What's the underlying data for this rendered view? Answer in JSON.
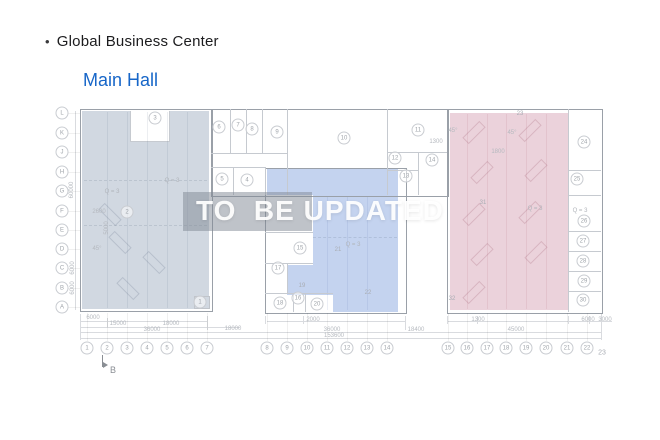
{
  "header": {
    "bullet": "•",
    "title": "Global Business Center",
    "subtitle": "Main Hall"
  },
  "watermark": {
    "text": "TO  BE UPDATED"
  },
  "colors": {
    "left_region": "#cdd5de",
    "middle_region": "#bfcfee",
    "right_region": "#e9ced8",
    "subtitle_blue": "#1766c8"
  },
  "plan": {
    "grid_rows": [
      "L",
      "K",
      "J",
      "H",
      "G",
      "F",
      "E",
      "D",
      "C",
      "B",
      "A"
    ],
    "grid_cols": [
      "1",
      "2",
      "3",
      "4",
      "5",
      "6",
      "7",
      "8",
      "9",
      "10",
      "11",
      "12",
      "13",
      "14",
      "15",
      "16",
      "17",
      "18",
      "19",
      "20",
      "21",
      "22",
      "23"
    ],
    "rooms": [
      {
        "n": "1",
        "x": 200,
        "y": 302
      },
      {
        "n": "2",
        "x": 127,
        "y": 212
      },
      {
        "n": "3",
        "x": 155,
        "y": 118
      },
      {
        "n": "4",
        "x": 247,
        "y": 180
      },
      {
        "n": "5",
        "x": 222,
        "y": 179
      },
      {
        "n": "6",
        "x": 219,
        "y": 127
      },
      {
        "n": "7",
        "x": 238,
        "y": 125
      },
      {
        "n": "8",
        "x": 252,
        "y": 129
      },
      {
        "n": "9",
        "x": 277,
        "y": 132
      },
      {
        "n": "10",
        "x": 344,
        "y": 138
      },
      {
        "n": "11",
        "x": 418,
        "y": 130
      },
      {
        "n": "12",
        "x": 395,
        "y": 158
      },
      {
        "n": "13",
        "x": 406,
        "y": 176
      },
      {
        "n": "14",
        "x": 432,
        "y": 160
      },
      {
        "n": "15",
        "x": 300,
        "y": 248
      },
      {
        "n": "16",
        "x": 298,
        "y": 298
      },
      {
        "n": "17",
        "x": 278,
        "y": 268
      },
      {
        "n": "18",
        "x": 280,
        "y": 303
      },
      {
        "n": "19",
        "x": 302,
        "y": 286,
        "plain": true
      },
      {
        "n": "20",
        "x": 317,
        "y": 304
      },
      {
        "n": "21",
        "x": 338,
        "y": 250,
        "plain": true
      },
      {
        "n": "22",
        "x": 368,
        "y": 293,
        "plain": true
      },
      {
        "n": "23",
        "x": 520,
        "y": 114,
        "plain": true
      },
      {
        "n": "24",
        "x": 584,
        "y": 142
      },
      {
        "n": "25",
        "x": 577,
        "y": 179
      },
      {
        "n": "26",
        "x": 584,
        "y": 221
      },
      {
        "n": "27",
        "x": 583,
        "y": 241
      },
      {
        "n": "28",
        "x": 583,
        "y": 261
      },
      {
        "n": "29",
        "x": 584,
        "y": 281
      },
      {
        "n": "30",
        "x": 583,
        "y": 300
      },
      {
        "n": "31",
        "x": 483,
        "y": 203,
        "plain": true
      },
      {
        "n": "32",
        "x": 452,
        "y": 299,
        "plain": true
      }
    ],
    "area_labels": [
      {
        "t": "Q = 3",
        "x": 172,
        "y": 181
      },
      {
        "t": "Q = 3",
        "x": 112,
        "y": 192
      },
      {
        "t": "Q = 3",
        "x": 353,
        "y": 245
      },
      {
        "t": "Q = 3",
        "x": 535,
        "y": 209
      },
      {
        "t": "Q = 3",
        "x": 580,
        "y": 211
      }
    ],
    "dims": [
      {
        "t": "6000",
        "x": 93,
        "y": 318
      },
      {
        "t": "15000",
        "x": 118,
        "y": 324
      },
      {
        "t": "18000",
        "x": 171,
        "y": 324
      },
      {
        "t": "36000",
        "x": 152,
        "y": 330
      },
      {
        "t": "18000",
        "x": 233,
        "y": 329
      },
      {
        "t": "2000",
        "x": 313,
        "y": 320
      },
      {
        "t": "36000",
        "x": 332,
        "y": 330
      },
      {
        "t": "153600",
        "x": 334,
        "y": 336
      },
      {
        "t": "18400",
        "x": 416,
        "y": 330
      },
      {
        "t": "1300",
        "x": 478,
        "y": 320
      },
      {
        "t": "45000",
        "x": 516,
        "y": 330
      },
      {
        "t": "6000",
        "x": 588,
        "y": 320
      },
      {
        "t": "3000",
        "x": 605,
        "y": 320
      },
      {
        "t": "60000",
        "x": 72,
        "y": 190,
        "rot": true
      },
      {
        "t": "6000",
        "x": 73,
        "y": 268,
        "rot": true
      },
      {
        "t": "6000",
        "x": 73,
        "y": 288,
        "rot": true
      },
      {
        "t": "2600",
        "x": 99,
        "y": 212
      },
      {
        "t": "5000",
        "x": 107,
        "y": 228,
        "rot": true
      },
      {
        "t": "1800",
        "x": 498,
        "y": 152
      },
      {
        "t": "1300",
        "x": 436,
        "y": 142
      },
      {
        "t": "45°",
        "x": 453,
        "y": 131
      },
      {
        "t": "45°",
        "x": 512,
        "y": 133
      },
      {
        "t": "45°",
        "x": 97,
        "y": 249
      }
    ],
    "section_marker": {
      "label": "B"
    }
  }
}
